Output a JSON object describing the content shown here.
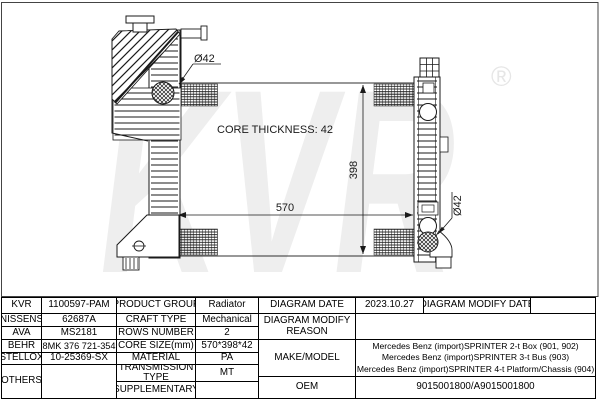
{
  "diagram": {
    "watermark": "KVR",
    "registered_mark": "®",
    "core_thickness_label": "CORE THICKNESS: 42",
    "width_dimension": "570",
    "height_dimension": "398",
    "inlet_diameter_label": "Ø42",
    "outlet_diameter_label": "Ø42"
  },
  "table": {
    "left": {
      "rows": [
        {
          "brand": "KVR",
          "number": "1100597-PAM",
          "property": "PRODUCT GROUP",
          "value": "Radiator"
        },
        {
          "brand": "NISSENS",
          "number": "62687A",
          "property": "CRAFT TYPE",
          "value": "Mechanical"
        },
        {
          "brand": "AVA",
          "number": "MS2181",
          "property": "ROWS NUMBER",
          "value": "2"
        },
        {
          "brand": "BEHR",
          "number": "8MK 376 721-354",
          "property": "CORE SIZE(mm)",
          "value": "570*398*42"
        },
        {
          "brand": "STELLOX",
          "number": "10-25369-SX",
          "property": "MATERIAL",
          "value": "PA"
        },
        {
          "brand": "OTHERS",
          "number": "",
          "property": "TRANSMISSION TYPE",
          "value": "MT"
        },
        {
          "brand": "",
          "number": "",
          "property": "SUPPLEMENTARY",
          "value": ""
        }
      ]
    },
    "right": {
      "diagram_date_label": "DIAGRAM DATE",
      "diagram_date": "2023.10.27",
      "diagram_modify_date_label": "DIAGRAM MODIFY DATE",
      "diagram_modify_date": "",
      "modify_reason_label": "DIAGRAM MODIFY REASON",
      "modify_reason": "",
      "make_model_label": "MAKE/MODEL",
      "make_model_lines": [
        "Mercedes Benz (import)SPRINTER 2-t Box (901, 902)",
        "Mercedes Benz (import)SPRINTER 3-t Bus (903)",
        "Mercedes Benz (import)SPRINTER 4-t Platform/Chassis (904)"
      ],
      "oem_label": "OEM",
      "oem": "9015001800/A9015001800"
    }
  }
}
